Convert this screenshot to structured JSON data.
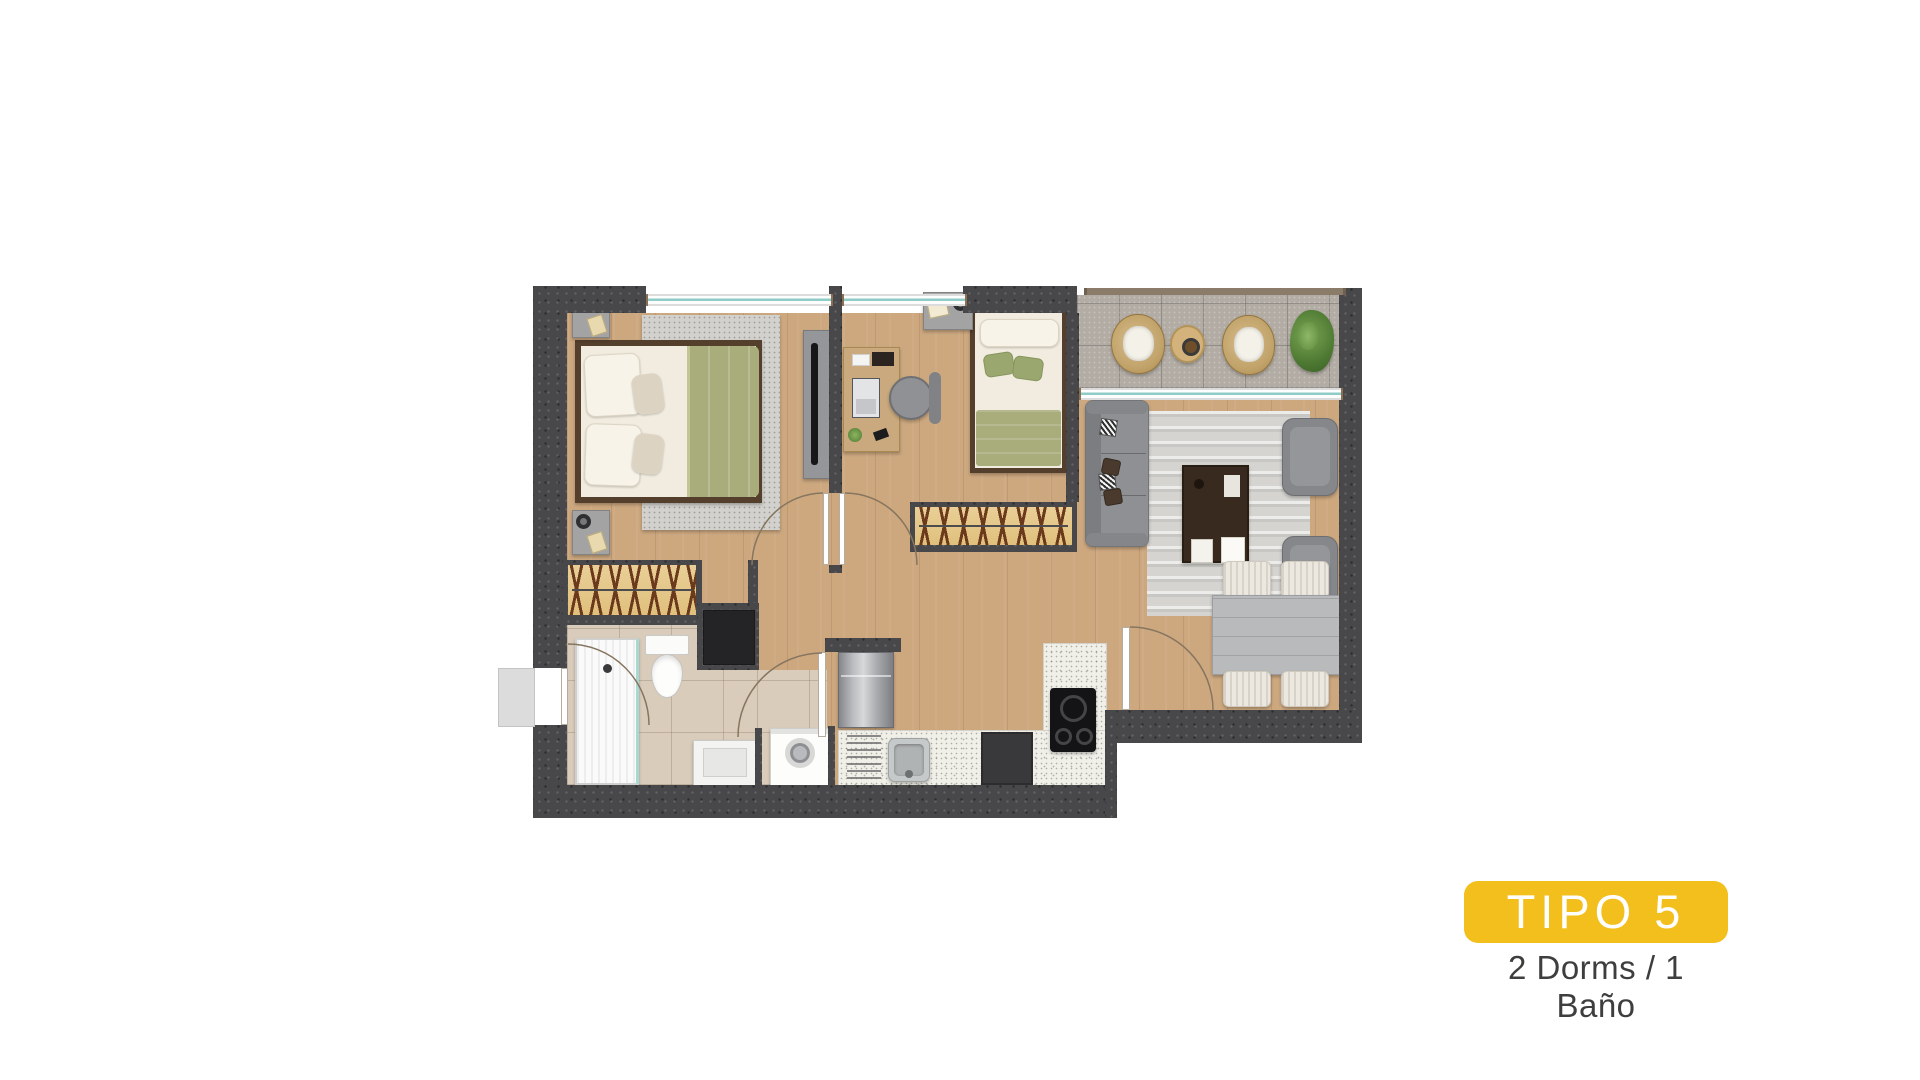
{
  "badge": {
    "label": "TIPO 5"
  },
  "caption": {
    "text": "2 Dorms / 1 Baño"
  },
  "theme": {
    "accent_yellow": "#F2BF1D",
    "badge_text": "#FFFFFF",
    "caption_text": "#3E3E3D",
    "wall": "#48484B",
    "wood_floor": "#CDA87F",
    "bath_tile": "#D9CCBA",
    "balcony_tile": "#B2ACA4",
    "counter": "#F0EFE8",
    "rug": "#D5D4D1",
    "sofa_gray": "#8E9093",
    "bed_green": "#A9AD7C",
    "wardrobe_wood": "#E9CF97",
    "window_teal": "#8FCCC8"
  }
}
